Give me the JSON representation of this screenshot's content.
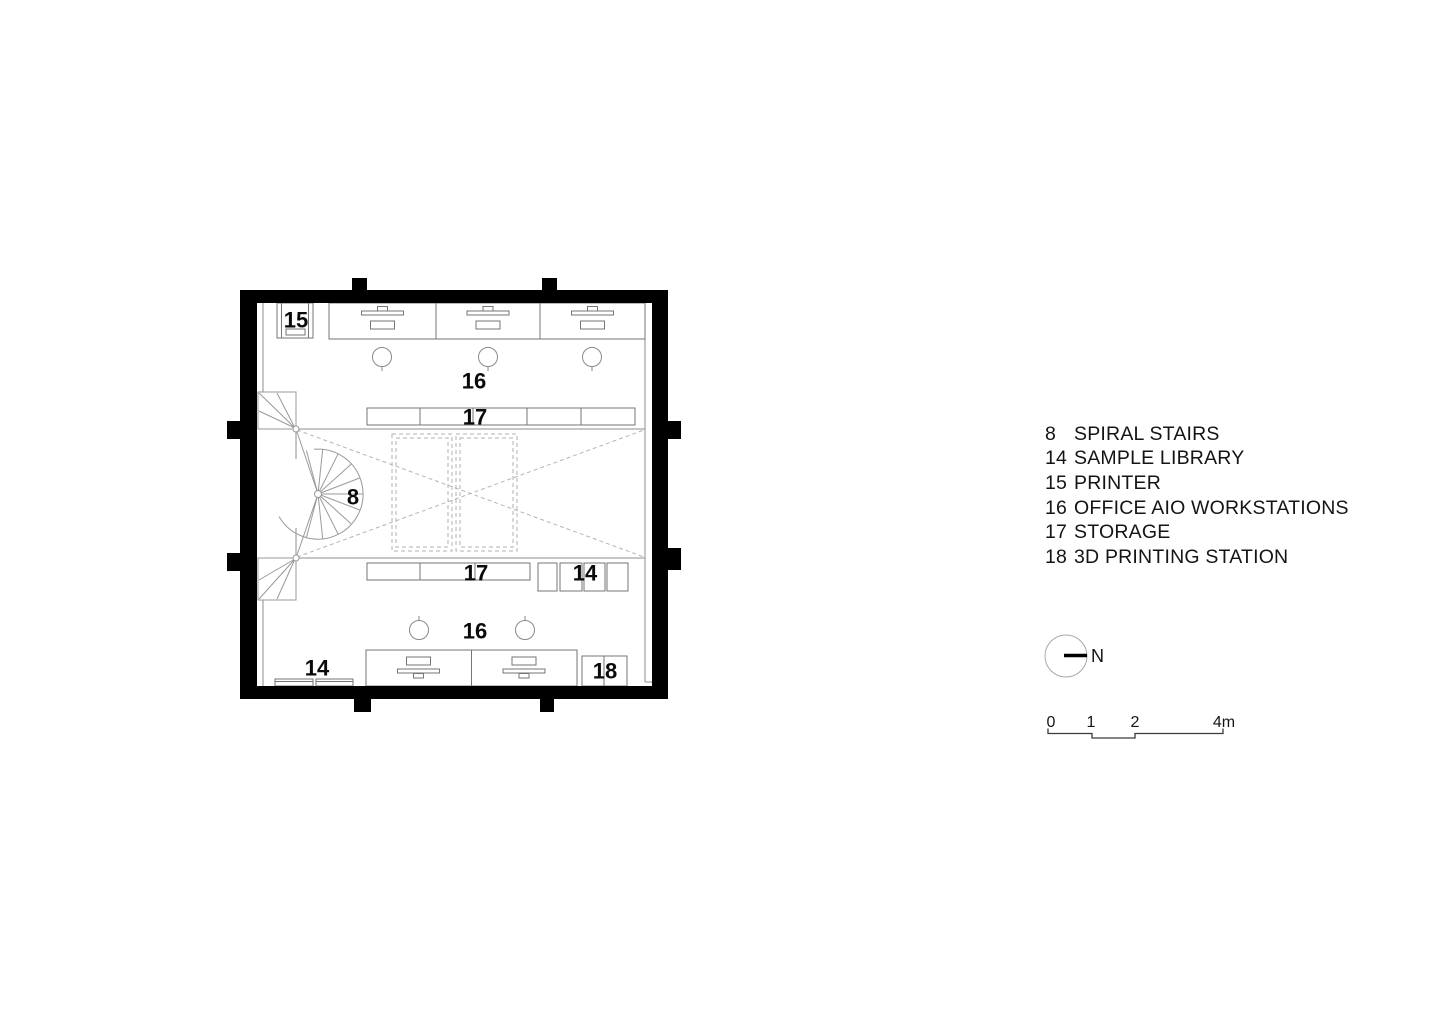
{
  "page": {
    "background": "#ffffff"
  },
  "colors": {
    "wall": "#000000",
    "furniture_line": "#767676",
    "structure_line": "#8c8c8c",
    "stair_line": "#9a9a9a",
    "dashed_line": "#b5b5b5",
    "label_text": "#0a0a0a",
    "legend_text": "#141414",
    "scale_line": "#3a3a3a",
    "north_circle": "#a8a8a8"
  },
  "plan": {
    "labels": {
      "printer": "15",
      "workstations_top": "16",
      "storage_top": "17",
      "spiral_stairs": "8",
      "storage_bottom": "17",
      "sample_library_mid": "14",
      "workstations_bottom": "16",
      "sample_library_bottom": "14",
      "printing_station": "18"
    }
  },
  "legend": {
    "items": [
      {
        "num": "8",
        "label": "SPIRAL STAIRS"
      },
      {
        "num": "14",
        "label": "SAMPLE LIBRARY"
      },
      {
        "num": "15",
        "label": "PRINTER"
      },
      {
        "num": "16",
        "label": "OFFICE AIO WORKSTATIONS"
      },
      {
        "num": "17",
        "label": "STORAGE"
      },
      {
        "num": "18",
        "label": "3D PRINTING STATION"
      }
    ]
  },
  "north": {
    "label": "N"
  },
  "scale_bar": {
    "ticks": [
      "0",
      "1",
      "2",
      "4m"
    ]
  }
}
